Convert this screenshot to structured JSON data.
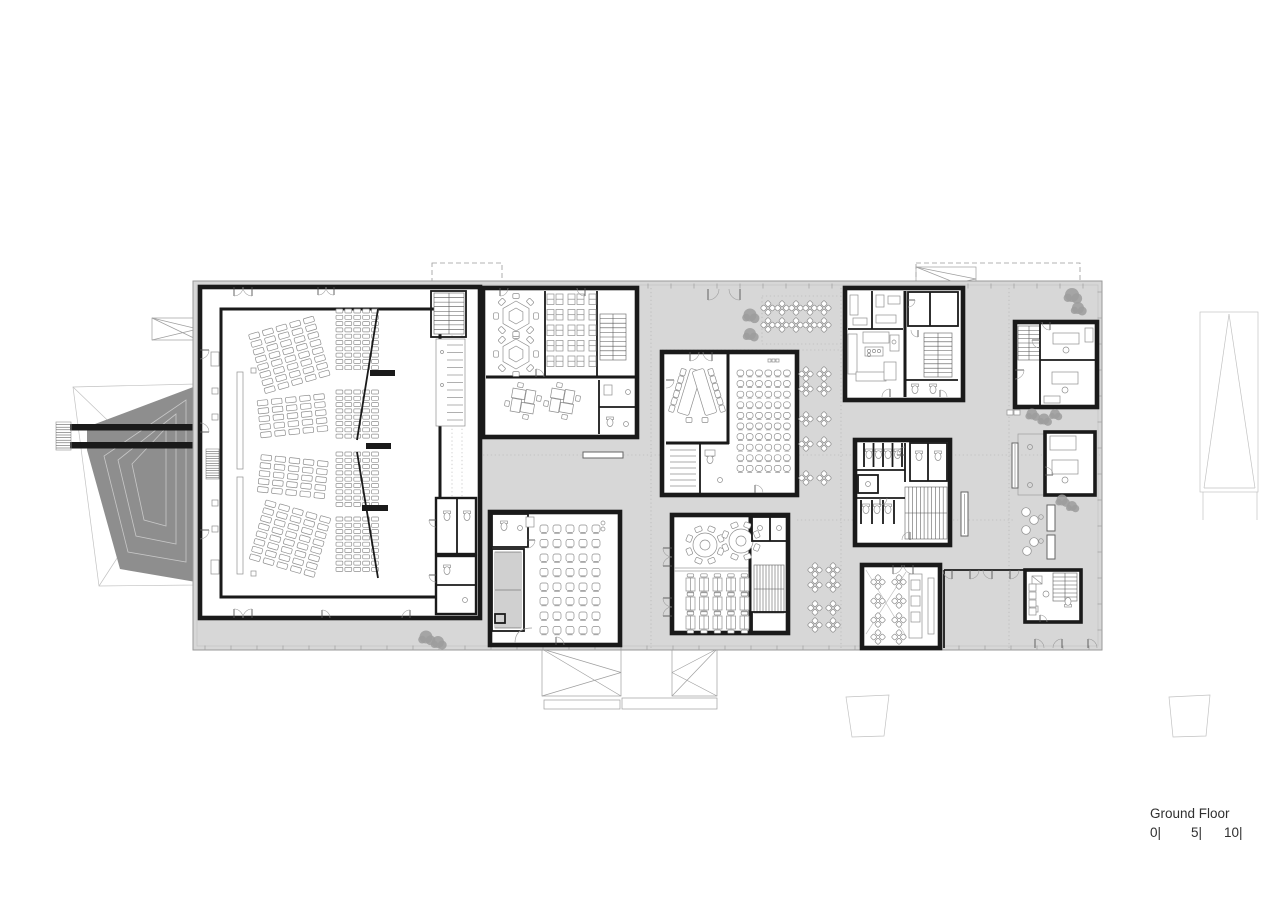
{
  "legend": {
    "title": "Ground Floor",
    "scale": [
      {
        "label": "0|"
      },
      {
        "label": "5|"
      },
      {
        "label": "10|"
      }
    ]
  },
  "colors": {
    "paper": "#ffffff",
    "slab": "#d7d7d7",
    "wall": "#1a1a1a",
    "wedge": "#8e8e8e",
    "line": "#8f8f8f",
    "tree": "#9c9c9c",
    "text": "#2f2f2f"
  }
}
